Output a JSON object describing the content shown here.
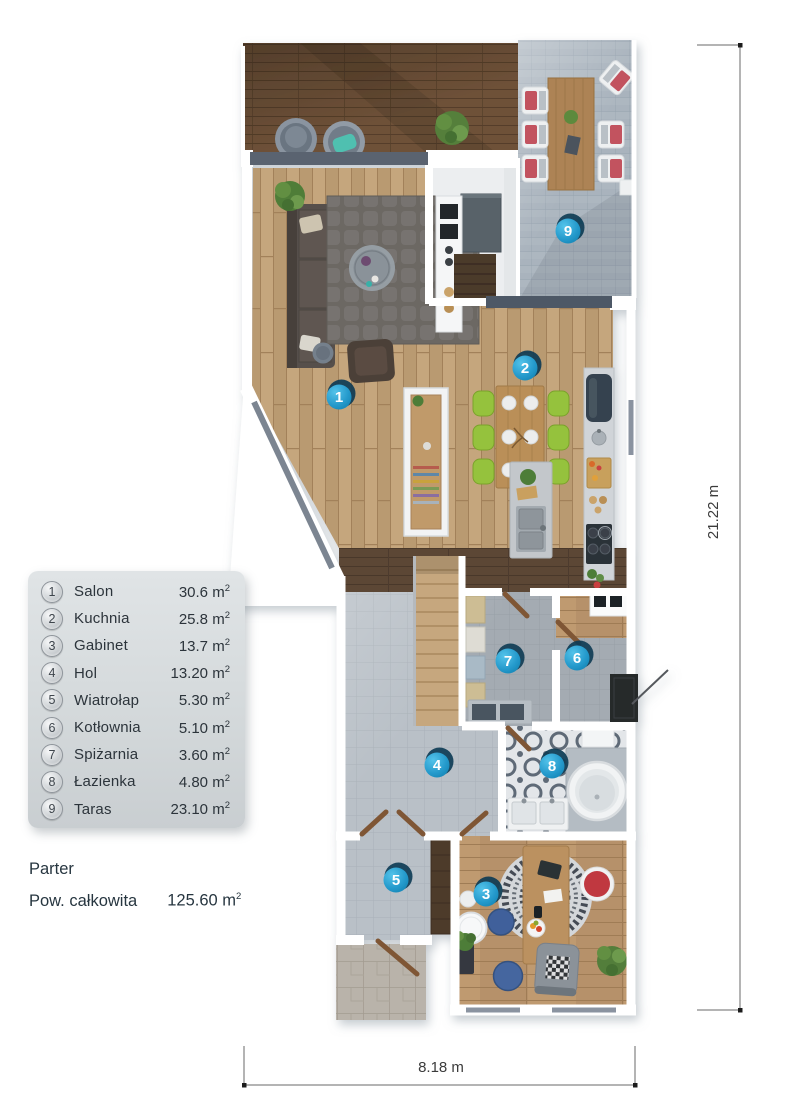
{
  "legend": {
    "rows": [
      {
        "num": "1",
        "name": "Salon",
        "area": "30.6"
      },
      {
        "num": "2",
        "name": "Kuchnia",
        "area": "25.8"
      },
      {
        "num": "3",
        "name": "Gabinet",
        "area": "13.7"
      },
      {
        "num": "4",
        "name": "Hol",
        "area": "13.20"
      },
      {
        "num": "5",
        "name": "Wiatrołap",
        "area": "5.30"
      },
      {
        "num": "6",
        "name": "Kotłownia",
        "area": "5.10"
      },
      {
        "num": "7",
        "name": "Spiżarnia",
        "area": "3.60"
      },
      {
        "num": "8",
        "name": "Łazienka",
        "area": "4.80"
      },
      {
        "num": "9",
        "name": "Taras",
        "area": "23.10"
      }
    ],
    "unit_base": "m",
    "unit_sup": "2"
  },
  "footer": {
    "floor_label": "Parter",
    "total_label": "Pow. całkowita",
    "total_value": "125.60"
  },
  "dimensions": {
    "vertical": "21.22 m",
    "horizontal": "8.18 m"
  },
  "plan": {
    "markers": [
      {
        "num": "1",
        "x": 339,
        "y": 397
      },
      {
        "num": "2",
        "x": 525,
        "y": 368
      },
      {
        "num": "3",
        "x": 486,
        "y": 894
      },
      {
        "num": "4",
        "x": 437,
        "y": 765
      },
      {
        "num": "5",
        "x": 396,
        "y": 880
      },
      {
        "num": "6",
        "x": 577,
        "y": 658
      },
      {
        "num": "7",
        "x": 508,
        "y": 661
      },
      {
        "num": "8",
        "x": 552,
        "y": 766
      },
      {
        "num": "9",
        "x": 568,
        "y": 231
      }
    ],
    "colors": {
      "marker_blue": "#2196c9",
      "marker_shadow": "#0e3c55",
      "deck_wood": "#6e5138",
      "floor_wood": "#c5a67d",
      "tile_gray": "#b9c0c7",
      "paver_gray": "#a9b3bd",
      "bath_tile_accent": "#5e6b77",
      "wall_white": "#ffffff"
    }
  }
}
